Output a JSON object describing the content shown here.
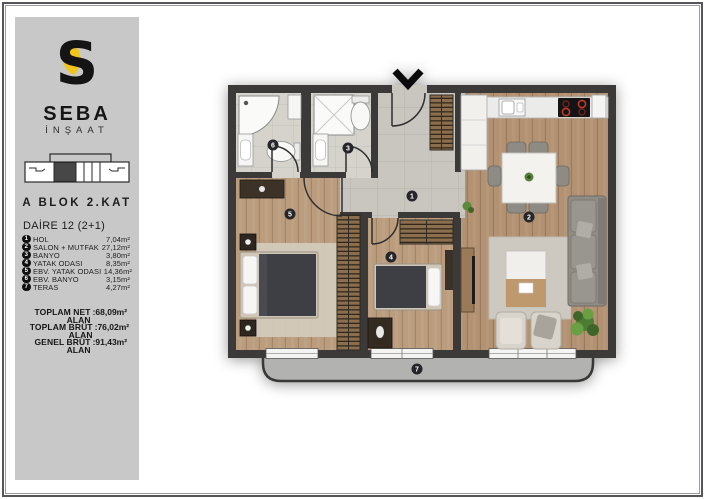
{
  "brand": {
    "name": "SEBA",
    "subtitle": "İNŞAAT"
  },
  "header": {
    "block_title": "A BLOK 2.KAT",
    "unit_title": "DAİRE 12 (2+1)"
  },
  "rooms": [
    {
      "num": "1",
      "name": "HOL",
      "area": "7,04m²"
    },
    {
      "num": "2",
      "name": "SALON + MUTFAK",
      "area": "27,12m²"
    },
    {
      "num": "3",
      "name": "BANYO",
      "area": "3,80m²"
    },
    {
      "num": "4",
      "name": "YATAK ODASI",
      "area": "8,35m²"
    },
    {
      "num": "5",
      "name": "EBV. YATAK ODASI",
      "area": "14,36m²"
    },
    {
      "num": "6",
      "name": "EBV. BANYO",
      "area": "3,15m²"
    },
    {
      "num": "7",
      "name": "TERAS",
      "area": "4,27m²"
    }
  ],
  "totals": [
    {
      "label": "TOPLAM NET ALAN",
      "value": ":68,09m²"
    },
    {
      "label": "TOPLAM BRÜT ALAN",
      "value": ":76,02m²"
    },
    {
      "label": "GENEL BRÜT ALAN",
      "value": ":91,43m²"
    }
  ],
  "colors": {
    "accent_yellow": "#F2C51D",
    "wall_dark": "#3B3A38",
    "sidebar_bg": "#C8C8C8",
    "floor_wood_living": "#B29272",
    "floor_wood_bedroom": "#BB9D7E",
    "floor_tile_bath": "#D6D3CD",
    "floor_tile_hall": "#C9C6C0",
    "terrace_gray": "#B2B2B0",
    "burner_red": "#C03A2B"
  }
}
